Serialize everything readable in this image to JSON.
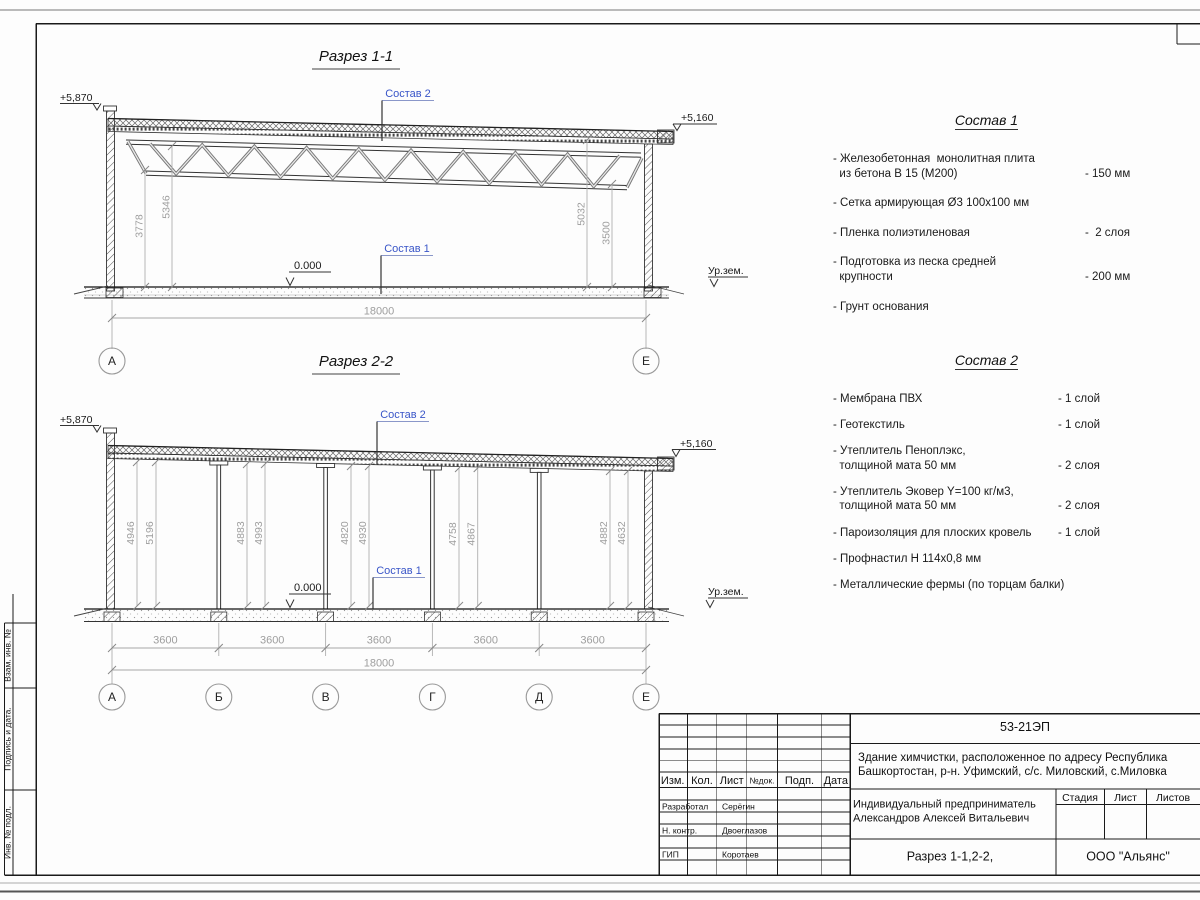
{
  "section1": {
    "title": "Разрез 1-1",
    "elev_left": "+5,870",
    "elev_right": "+5,160",
    "zero_mark": "0.000",
    "ground": "Ур.зем.",
    "sostav1_ref": "Состав 1",
    "sostav2_ref": "Состав 2",
    "dim_left_outer": "3778",
    "dim_left_inner": "5346",
    "dim_right_inner": "5032",
    "dim_right_outer": "3500",
    "dim_total": "18000",
    "axis_left": "А",
    "axis_right": "Е"
  },
  "section2": {
    "title": "Разрез 2-2",
    "elev_left": "+5,870",
    "elev_right": "+5,160",
    "zero_mark": "0.000",
    "ground": "Ур.зем.",
    "sostav1_ref": "Состав 1",
    "sostav2_ref": "Состав 2",
    "pairs": [
      [
        "4946",
        "5196"
      ],
      [
        "4883",
        "4993"
      ],
      [
        "4820",
        "4930"
      ],
      [
        "4758",
        "4867"
      ],
      [
        "4882",
        "4632"
      ]
    ],
    "spans": [
      "3600",
      "3600",
      "3600",
      "3600",
      "3600"
    ],
    "dim_total": "18000",
    "axes": [
      "А",
      "Б",
      "В",
      "Г",
      "Д",
      "Е"
    ]
  },
  "sostav1": {
    "title": "Состав 1",
    "items": [
      {
        "text": "- Железобетонная  монолитная плита\n  из бетона В 15 (М200)",
        "value": "- 150 мм"
      },
      {
        "text": "- Сетка армирующая Ø3 100х100 мм",
        "value": ""
      },
      {
        "text": "- Пленка полиэтиленовая",
        "value": "-  2 слоя"
      },
      {
        "text": "- Подготовка из песка средней\n  крупности",
        "value": "- 200 мм"
      },
      {
        "text": "- Грунт основания",
        "value": ""
      }
    ]
  },
  "sostav2": {
    "title": "Состав 2",
    "items": [
      {
        "text": "- Мембрана ПВХ",
        "value": "- 1 слой"
      },
      {
        "text": "- Геотекстиль",
        "value": "- 1 слой"
      },
      {
        "text": "- Утеплитель Пеноплэкс,\n  толщиной мата 50 мм",
        "value": "- 2 слоя"
      },
      {
        "text": "- Утеплитель Эковер Y=100 кг/м3,\n  толщиной мата 50 мм",
        "value": "- 2 слоя"
      },
      {
        "text": "- Пароизоляция для плоских кровель",
        "value": "- 1 слой"
      },
      {
        "text": "- Профнастил Н 114х0,8 мм",
        "value": ""
      },
      {
        "text": "- Металлические фермы (по торцам балки)",
        "value": ""
      }
    ]
  },
  "stamp": {
    "code": "53-21ЭП",
    "object_line1": "Здание химчистки,  расположенное по адресу Республика",
    "object_line2": "Башкортостан, р-н. Уфимский, с/с. Миловский, с.Миловка",
    "client_line1": "Индивидуальный предприниматель",
    "client_line2": "Александров Алексей Витальевич",
    "doc_title": "Разрез 1-1,2-2,",
    "company": "ООО \"Альянс\"",
    "stage_label": "Стадия",
    "sheet_label": "Лист",
    "sheets_label": "Листов",
    "header_cells": [
      "Изм.",
      "Кол.",
      "Лист",
      "№док.",
      "Подп.",
      "Дата"
    ],
    "roles": [
      {
        "role": "Разработал",
        "name": "Серёгин"
      },
      {
        "role": "Н. контр.",
        "name": "Двоеглазов"
      },
      {
        "role": "ГИП",
        "name": "Коротаев"
      }
    ],
    "margin_labels": [
      "Взам. инв. №",
      "Подпись и дата.",
      "Инв. № подл."
    ]
  }
}
